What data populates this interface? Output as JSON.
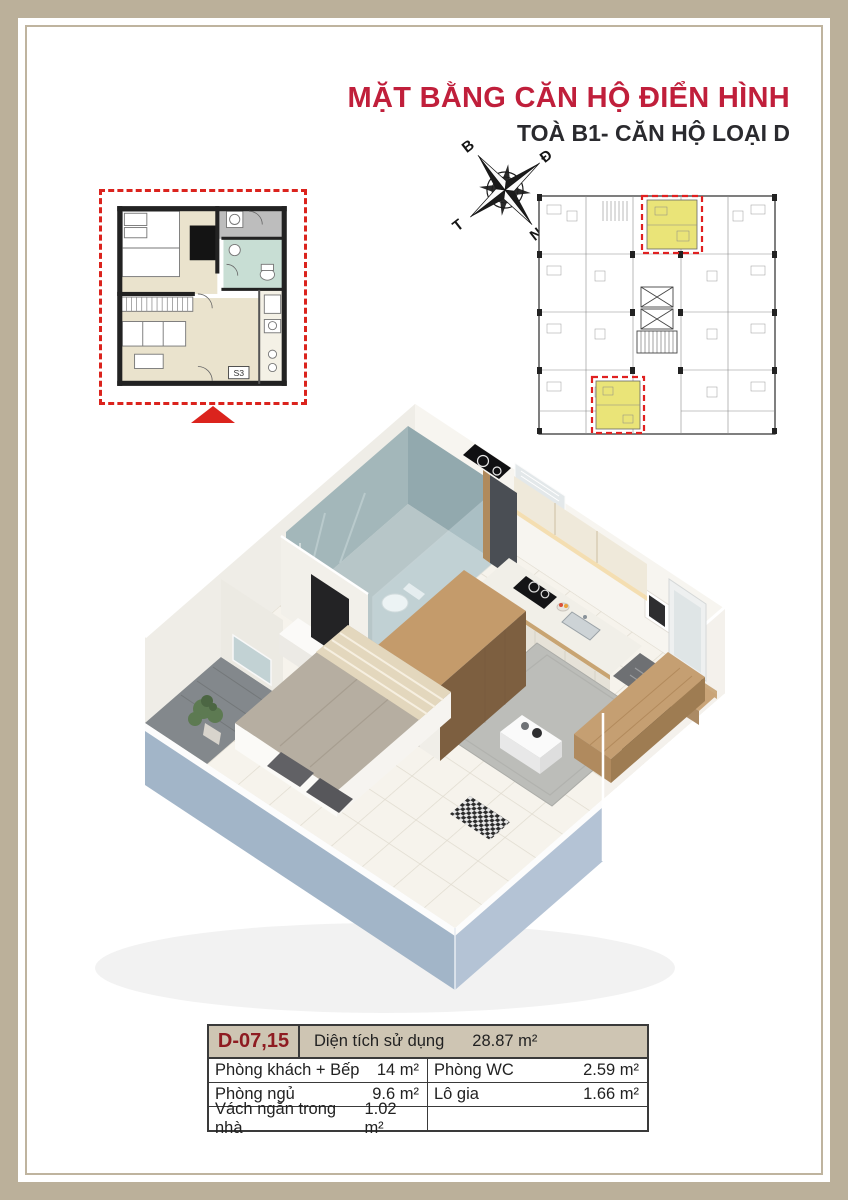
{
  "document": {
    "title": "MẶT BẰNG CĂN HỘ ĐIỂN HÌNH",
    "subtitle": "TOÀ B1- CĂN HỘ LOẠI D"
  },
  "compass": {
    "north": "B",
    "east": "Đ",
    "south": "N",
    "west": "T"
  },
  "floor_plan_2d": {
    "unit_label": "S3"
  },
  "unit_table": {
    "unit_code": "D-07,15",
    "total_label": "Diện tích sử dụng",
    "total_value": "28.87 m²",
    "rows_left": [
      {
        "label": "Phòng khách + Bếp",
        "value": "14 m²"
      },
      {
        "label": "Phòng ngủ",
        "value": "9.6 m²"
      },
      {
        "label": "Vách ngăn trong nhà",
        "value": "1.02 m²"
      }
    ],
    "rows_right": [
      {
        "label": "Phòng WC",
        "value": "2.59 m²"
      },
      {
        "label": "Lô gia",
        "value": "1.66 m²"
      },
      {
        "label": "",
        "value": ""
      }
    ]
  },
  "colors": {
    "accent_red": "#C01F3B",
    "dashed_red": "#DB231D",
    "unit_code_red": "#8E1B21",
    "frame_beige": "#BBB09A",
    "table_header_beige": "#CEC5B3",
    "highlight_yellow": "#EAE478",
    "outer_wall_blue": "#AFBFD2"
  }
}
